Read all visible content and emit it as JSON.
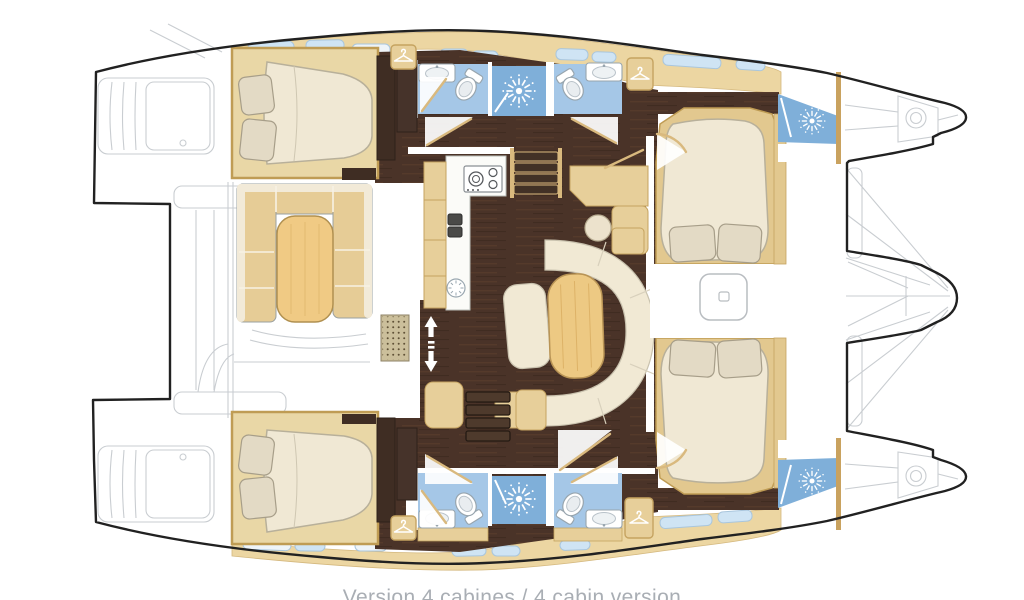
{
  "caption": {
    "text": "Version 4 cabines / 4 cabin version",
    "color": "#a9aeb4"
  },
  "diagram": {
    "type": "boat-floor-plan",
    "subject": "catamaran interior deck plan, 4 cabin version",
    "orientation": {
      "bow": "right",
      "stern": "left"
    },
    "rooms": [
      "port aft cabin",
      "port forward cabin",
      "starboard aft cabin",
      "starboard forward cabin",
      "port aft bathroom",
      "port forward bathroom",
      "starboard aft bathroom",
      "starboard forward bathroom",
      "port shower",
      "starboard shower",
      "port forward shower",
      "starboard forward shower",
      "galley",
      "salon settee with table",
      "dinette with table",
      "companionway steps",
      "aft cockpit",
      "port transom",
      "starboard transom",
      "trampoline and bows",
      "forward nacelle"
    ],
    "icons": [
      {
        "name": "shower-sun-icon",
        "count": 4
      },
      {
        "name": "hanger-icon",
        "count": 4
      },
      {
        "name": "toilet-fixture",
        "count": 4
      },
      {
        "name": "sink-fixture",
        "count": 4
      },
      {
        "name": "stove-burners-icon",
        "count": 1
      },
      {
        "name": "up-down-arrows-icon",
        "count": 1
      },
      {
        "name": "floor-grate",
        "count": 1
      },
      {
        "name": "escape-hatch",
        "count": 1
      }
    ],
    "palette": {
      "outline": "#212121",
      "floor_brown": "#4a3328",
      "furniture_tan": "#e6cc96",
      "deck_tan": "#ecd6a2",
      "cabinet_tan": "#e7cf9a",
      "frame_tan": "#bf9c54",
      "bed_cream": "#f0e8d4",
      "pillow": "#e3dac5",
      "settee_cream": "#f1e9d4",
      "table_wood": "#edc983",
      "bath_blue": "#a5c7e7",
      "shower_blue": "#7fafd9",
      "window_blue": "#cfe4f4",
      "faint_line": "#c9cdd1",
      "background": "#ffffff"
    }
  }
}
